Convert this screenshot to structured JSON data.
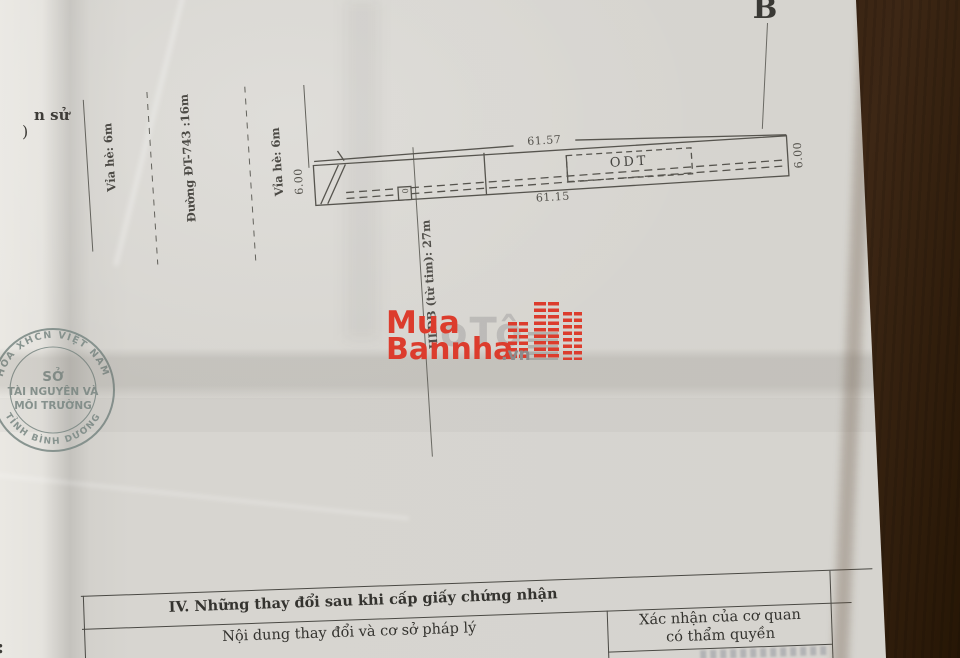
{
  "photo": {
    "marker_b": "B",
    "edge_fragments": {
      "top1": "n sử",
      "top2": ")",
      "bottom": ":"
    }
  },
  "site_plan": {
    "labels": {
      "sidewalk_left": "Vỉa hè: 6m",
      "road": "Đường ĐT-743 :16m",
      "sidewalk_right": "Vỉa hè: 6m",
      "alley": "HLĐB (từ tim): 27m"
    },
    "parcel": {
      "zone": "ODT",
      "dim_top": "61.57",
      "dim_bottom": "61.15",
      "dim_left": "6.00",
      "dim_right": "6.00",
      "alley_box": "0"
    }
  },
  "stamp": {
    "arc_top": "HÒA XHCN VIỆT NAM",
    "center_line1": "SỞ",
    "center_line2": "TÀI NGUYÊN VÀ",
    "center_line3": "MÔI TRƯỜNG",
    "arc_bottom": "TỈNH BÌNH DƯƠNG",
    "color": "#7c8a86"
  },
  "watermark": {
    "word1": "Mua",
    "word2": "Bannha",
    "suffix": ".vn",
    "ghost": "oTô",
    "red": "#dc3c2d",
    "gray": "#8b8b8b"
  },
  "changes_table": {
    "section_title": "IV. Những thay đổi sau khi cấp giấy chứng nhận",
    "col_left": "Nội dung thay đổi và cơ sở pháp lý",
    "col_right_line1": "Xác nhận của cơ quan",
    "col_right_line2": "có thẩm quyền"
  }
}
